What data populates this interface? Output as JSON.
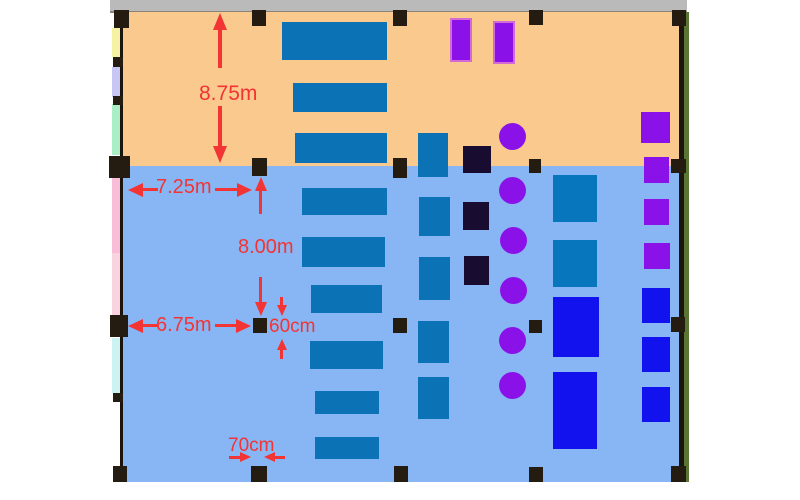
{
  "diagram_type": "office-floor-plan",
  "dimensions": {
    "upper_room_depth": "8.75m",
    "upper_span": "7.25m",
    "lower_room_depth": "8.00m",
    "lower_span": "6.75m",
    "column_height": "60cm",
    "column_width": "70cm"
  },
  "colors": {
    "zone_upper": "#F9C98E",
    "zone_lower": "#88B6F4",
    "desk_blue": "#0B72B6",
    "teal_square": "#0876BC",
    "bright_blue": "#1212EF",
    "purple": "#8A12E8",
    "purple_border": "#D46AD4",
    "navy": "#180C30",
    "column_black": "#241B11",
    "wall_gray": "#BABABA",
    "wall_gray_edge": "#8B8378",
    "wall_dark": "#1C150D",
    "wall_green": "#5B7634",
    "dimension_red": "#F23434",
    "strip_yellow": "#F5F2A3",
    "strip_lavender": "#C8C6F4",
    "strip_mint": "#AAEEC5",
    "strip_pink": "#F8BED7",
    "strip_pink_light": "#FAD3E1",
    "strip_cyan": "#CCF2F1"
  },
  "floorplan": {
    "items": [
      {
        "name": "room-strip-yellow",
        "shape": "rect",
        "x": 112,
        "y": 28,
        "w": 8,
        "h": 29,
        "color": "strip_yellow"
      },
      {
        "name": "room-strip-lavender",
        "shape": "rect",
        "x": 112,
        "y": 67,
        "w": 8,
        "h": 30,
        "color": "strip_lavender"
      },
      {
        "name": "room-strip-mint",
        "shape": "rect",
        "x": 112,
        "y": 104,
        "w": 8,
        "h": 51,
        "color": "strip_mint"
      },
      {
        "name": "room-strip-pink",
        "shape": "rect",
        "x": 112,
        "y": 177,
        "w": 8,
        "h": 76,
        "color": "strip_pink"
      },
      {
        "name": "room-strip-pink-light",
        "shape": "rect",
        "x": 112,
        "y": 253,
        "w": 8,
        "h": 62,
        "color": "strip_pink_light"
      },
      {
        "name": "room-strip-cyan",
        "shape": "rect",
        "x": 112,
        "y": 338,
        "w": 8,
        "h": 55,
        "color": "strip_cyan"
      },
      {
        "name": "desk-rect",
        "shape": "rect",
        "x": 282,
        "y": 22,
        "w": 105,
        "h": 38,
        "color": "desk_blue"
      },
      {
        "name": "desk-rect",
        "shape": "rect",
        "x": 293,
        "y": 83,
        "w": 94,
        "h": 29,
        "color": "desk_blue"
      },
      {
        "name": "desk-rect",
        "shape": "rect",
        "x": 295,
        "y": 133,
        "w": 92,
        "h": 30,
        "color": "desk_blue"
      },
      {
        "name": "desk-rect",
        "shape": "rect",
        "x": 302,
        "y": 188,
        "w": 85,
        "h": 27,
        "color": "desk_blue"
      },
      {
        "name": "desk-rect",
        "shape": "rect",
        "x": 302,
        "y": 237,
        "w": 83,
        "h": 30,
        "color": "desk_blue"
      },
      {
        "name": "desk-rect",
        "shape": "rect",
        "x": 311,
        "y": 285,
        "w": 71,
        "h": 28,
        "color": "desk_blue"
      },
      {
        "name": "desk-rect",
        "shape": "rect",
        "x": 310,
        "y": 341,
        "w": 73,
        "h": 28,
        "color": "desk_blue"
      },
      {
        "name": "desk-rect",
        "shape": "rect",
        "x": 315,
        "y": 391,
        "w": 64,
        "h": 23,
        "color": "desk_blue"
      },
      {
        "name": "desk-rect",
        "shape": "rect",
        "x": 315,
        "y": 437,
        "w": 64,
        "h": 22,
        "color": "desk_blue"
      },
      {
        "name": "cabinet-rect",
        "shape": "rect",
        "x": 418,
        "y": 133,
        "w": 30,
        "h": 44,
        "color": "desk_blue"
      },
      {
        "name": "cabinet-rect",
        "shape": "rect",
        "x": 419,
        "y": 197,
        "w": 31,
        "h": 39,
        "color": "desk_blue"
      },
      {
        "name": "cabinet-rect",
        "shape": "rect",
        "x": 419,
        "y": 257,
        "w": 31,
        "h": 43,
        "color": "desk_blue"
      },
      {
        "name": "cabinet-rect",
        "shape": "rect",
        "x": 418,
        "y": 321,
        "w": 31,
        "h": 42,
        "color": "desk_blue"
      },
      {
        "name": "cabinet-rect",
        "shape": "rect",
        "x": 418,
        "y": 377,
        "w": 31,
        "h": 42,
        "color": "desk_blue"
      },
      {
        "name": "table-square",
        "shape": "rect",
        "x": 553,
        "y": 175,
        "w": 44,
        "h": 47,
        "color": "teal_square"
      },
      {
        "name": "table-square",
        "shape": "rect",
        "x": 553,
        "y": 240,
        "w": 44,
        "h": 47,
        "color": "teal_square"
      },
      {
        "name": "equipment-rect",
        "shape": "rect",
        "x": 553,
        "y": 297,
        "w": 46,
        "h": 60,
        "color": "bright_blue"
      },
      {
        "name": "equipment-rect",
        "shape": "rect",
        "x": 553,
        "y": 372,
        "w": 44,
        "h": 77,
        "color": "bright_blue"
      },
      {
        "name": "equipment-square",
        "shape": "rect",
        "x": 642,
        "y": 288,
        "w": 28,
        "h": 35,
        "color": "bright_blue"
      },
      {
        "name": "equipment-square",
        "shape": "rect",
        "x": 642,
        "y": 337,
        "w": 28,
        "h": 35,
        "color": "bright_blue"
      },
      {
        "name": "equipment-square",
        "shape": "rect",
        "x": 642,
        "y": 387,
        "w": 28,
        "h": 35,
        "color": "bright_blue"
      },
      {
        "name": "storage-navy-square",
        "shape": "rect",
        "x": 463,
        "y": 146,
        "w": 28,
        "h": 27,
        "color": "navy"
      },
      {
        "name": "storage-navy-square",
        "shape": "rect",
        "x": 463,
        "y": 202,
        "w": 26,
        "h": 28,
        "color": "navy"
      },
      {
        "name": "storage-navy-square",
        "shape": "rect",
        "x": 464,
        "y": 256,
        "w": 25,
        "h": 29,
        "color": "navy"
      },
      {
        "name": "partition-purple-rect",
        "shape": "rect",
        "x": 450,
        "y": 18,
        "w": 18,
        "h": 40,
        "color": "purple",
        "border": "purple_border"
      },
      {
        "name": "partition-purple-rect",
        "shape": "rect",
        "x": 493,
        "y": 21,
        "w": 18,
        "h": 39,
        "color": "purple",
        "border": "purple_border"
      },
      {
        "name": "shelf-purple-square",
        "shape": "rect",
        "x": 641,
        "y": 112,
        "w": 29,
        "h": 31,
        "color": "purple"
      },
      {
        "name": "shelf-purple-square",
        "shape": "rect",
        "x": 644,
        "y": 157,
        "w": 25,
        "h": 26,
        "color": "purple"
      },
      {
        "name": "shelf-purple-square",
        "shape": "rect",
        "x": 644,
        "y": 199,
        "w": 25,
        "h": 26,
        "color": "purple"
      },
      {
        "name": "shelf-purple-square",
        "shape": "rect",
        "x": 644,
        "y": 243,
        "w": 26,
        "h": 26,
        "color": "purple"
      },
      {
        "name": "chair-circle",
        "shape": "circle",
        "x": 499,
        "y": 123,
        "w": 27,
        "h": 27,
        "color": "purple"
      },
      {
        "name": "chair-circle",
        "shape": "circle",
        "x": 499,
        "y": 177,
        "w": 27,
        "h": 27,
        "color": "purple"
      },
      {
        "name": "chair-circle",
        "shape": "circle",
        "x": 500,
        "y": 227,
        "w": 27,
        "h": 27,
        "color": "purple"
      },
      {
        "name": "chair-circle",
        "shape": "circle",
        "x": 500,
        "y": 277,
        "w": 27,
        "h": 27,
        "color": "purple"
      },
      {
        "name": "chair-circle",
        "shape": "circle",
        "x": 499,
        "y": 327,
        "w": 27,
        "h": 27,
        "color": "purple"
      },
      {
        "name": "chair-circle",
        "shape": "circle",
        "x": 499,
        "y": 372,
        "w": 27,
        "h": 27,
        "color": "purple"
      },
      {
        "name": "column-marker",
        "shape": "rect",
        "x": 114,
        "y": 10,
        "w": 15,
        "h": 18,
        "color": "column_black"
      },
      {
        "name": "column-marker",
        "shape": "rect",
        "x": 252,
        "y": 10,
        "w": 14,
        "h": 16,
        "color": "column_black"
      },
      {
        "name": "column-marker",
        "shape": "rect",
        "x": 393,
        "y": 10,
        "w": 14,
        "h": 16,
        "color": "column_black"
      },
      {
        "name": "column-marker",
        "shape": "rect",
        "x": 529,
        "y": 10,
        "w": 14,
        "h": 15,
        "color": "column_black"
      },
      {
        "name": "column-marker",
        "shape": "rect",
        "x": 672,
        "y": 10,
        "w": 14,
        "h": 16,
        "color": "column_black"
      },
      {
        "name": "wall-tick",
        "shape": "rect",
        "x": 113,
        "y": 57,
        "w": 10,
        "h": 10,
        "color": "column_black"
      },
      {
        "name": "wall-tick",
        "shape": "rect",
        "x": 113,
        "y": 96,
        "w": 10,
        "h": 9,
        "color": "column_black"
      },
      {
        "name": "wall-tick",
        "shape": "rect",
        "x": 113,
        "y": 393,
        "w": 10,
        "h": 9,
        "color": "column_black"
      },
      {
        "name": "column-marker",
        "shape": "rect",
        "x": 109,
        "y": 156,
        "w": 21,
        "h": 22,
        "color": "column_black"
      },
      {
        "name": "column-marker",
        "shape": "rect",
        "x": 252,
        "y": 158,
        "w": 15,
        "h": 18,
        "color": "column_black"
      },
      {
        "name": "column-marker",
        "shape": "rect",
        "x": 393,
        "y": 158,
        "w": 14,
        "h": 20,
        "color": "column_black"
      },
      {
        "name": "column-marker",
        "shape": "rect",
        "x": 529,
        "y": 159,
        "w": 12,
        "h": 14,
        "color": "column_black"
      },
      {
        "name": "column-marker",
        "shape": "rect",
        "x": 671,
        "y": 159,
        "w": 15,
        "h": 14,
        "color": "column_black"
      },
      {
        "name": "column-marker",
        "shape": "rect",
        "x": 110,
        "y": 315,
        "w": 18,
        "h": 22,
        "color": "column_black"
      },
      {
        "name": "column-marker",
        "shape": "rect",
        "x": 253,
        "y": 318,
        "w": 14,
        "h": 15,
        "color": "column_black"
      },
      {
        "name": "column-marker",
        "shape": "rect",
        "x": 393,
        "y": 318,
        "w": 14,
        "h": 15,
        "color": "column_black"
      },
      {
        "name": "column-marker",
        "shape": "rect",
        "x": 529,
        "y": 320,
        "w": 13,
        "h": 13,
        "color": "column_black"
      },
      {
        "name": "column-marker",
        "shape": "rect",
        "x": 671,
        "y": 317,
        "w": 14,
        "h": 15,
        "color": "column_black"
      },
      {
        "name": "column-marker",
        "shape": "rect",
        "x": 113,
        "y": 466,
        "w": 14,
        "h": 16,
        "color": "column_black"
      },
      {
        "name": "column-marker",
        "shape": "rect",
        "x": 251,
        "y": 466,
        "w": 16,
        "h": 16,
        "color": "column_black"
      },
      {
        "name": "column-marker",
        "shape": "rect",
        "x": 394,
        "y": 466,
        "w": 14,
        "h": 16,
        "color": "column_black"
      },
      {
        "name": "column-marker",
        "shape": "rect",
        "x": 529,
        "y": 467,
        "w": 14,
        "h": 15,
        "color": "column_black"
      },
      {
        "name": "column-marker",
        "shape": "rect",
        "x": 671,
        "y": 466,
        "w": 15,
        "h": 16,
        "color": "column_black"
      }
    ]
  }
}
